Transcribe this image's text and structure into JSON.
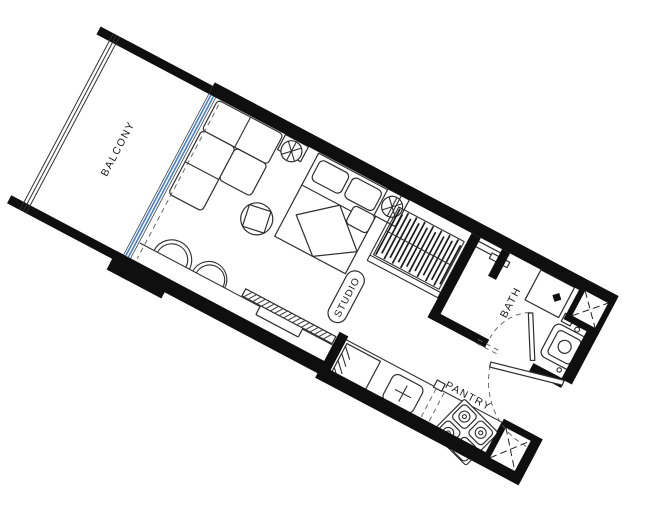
{
  "floor_plan": {
    "title": "Studio unit floor plan",
    "rotation_deg": 27.9,
    "rooms": [
      {
        "id": "balcony",
        "label": "BALCONY"
      },
      {
        "id": "studio",
        "label": "STUDIO"
      },
      {
        "id": "bath",
        "label": "BATH"
      },
      {
        "id": "pantry",
        "label": "PANTRY"
      }
    ],
    "colors": {
      "walls": "#0f0f0f",
      "furniture_line": "#2e2e2e",
      "glass_door": "#4a7fd0",
      "dashed_line": "#5a5a5a",
      "background": "#ffffff"
    },
    "fixtures": [
      "balcony-railing",
      "sliding-glass-door",
      "curtain-line",
      "sofa-sectional",
      "round-side-table",
      "ceiling-fan",
      "queen-bed",
      "media-ledge",
      "round-chairs",
      "tv-console",
      "wardrobe",
      "shower",
      "wash-basin",
      "toilet",
      "vent-shaft",
      "bath-door",
      "entry-door",
      "kitchen-counter",
      "refrigerator",
      "kitchen-sink",
      "gas-stove",
      "service-shaft"
    ]
  }
}
